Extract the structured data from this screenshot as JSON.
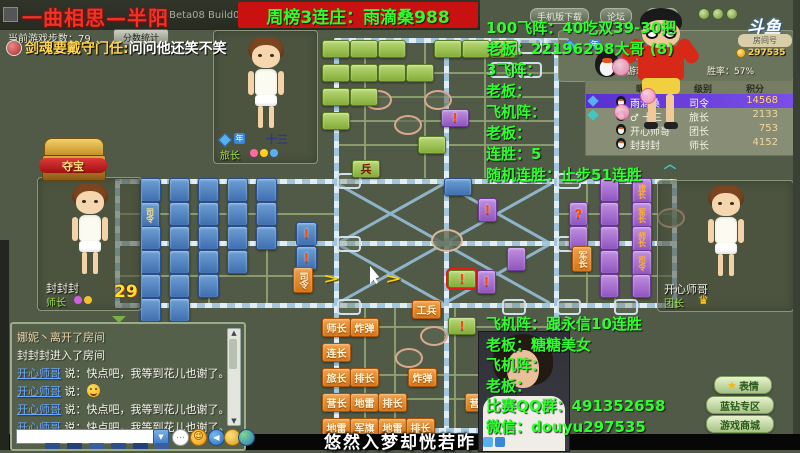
{
  "window": {
    "title": "一曲相思—半阳",
    "version": "2.1 Beta08 Build033",
    "banner": "周榜3连庄：雨滴桑988",
    "nav_buttons": [
      "手机版下载",
      "论坛",
      "设置"
    ],
    "logo": "斗鱼",
    "room_label": "房间号",
    "room_coins": "297535",
    "steps": "当前游戏步数：79",
    "score_button": "分数统计"
  },
  "overlay": {
    "chat_name": "剑魂要戴守门任:",
    "chat_msg": "问问他还笑不笑",
    "text_color": "#2dff2d",
    "right_top": [
      "100飞阵：40吃双39-30把",
      "老板：22196298大哥 (8)",
      "3飞阵：",
      "老板：",
      "飞机阵：",
      "老板：",
      "连胜：5",
      "随机连胜：止步51连胜"
    ],
    "right_bottom": [
      "飞机阵：跟永信10连胜",
      "老板：糖糖美女",
      "飞机阵：",
      "老板：",
      "比赛QQ群：491352658",
      "微信：douyu297535"
    ],
    "subtitle": "悠然入梦却恍若昨"
  },
  "players": {
    "top": {
      "name": "十三",
      "level": "旅长"
    },
    "left": {
      "name": "封封封",
      "level": "师长",
      "timer": "29"
    },
    "right": {
      "name": "开心师哥",
      "level": "团长"
    },
    "self_info": {
      "level": "级别：司令",
      "coins": "游戏币：0",
      "winrate": "胜率：57%"
    }
  },
  "ranking": {
    "headers": [
      "昵称",
      "级别",
      "积分"
    ],
    "rows": [
      {
        "icon": "#58b0f0",
        "name": "雨滴桑",
        "level": "司令",
        "score": "14568",
        "highlight": true
      },
      {
        "icon": "#40c8c0",
        "name": "♂ 十三",
        "level": "旅长",
        "score": "2133",
        "highlight": false
      },
      {
        "icon": "",
        "name": "开心师哥",
        "level": "团长",
        "score": "753",
        "highlight": false
      },
      {
        "icon": "",
        "name": "封封封",
        "level": "师长",
        "score": "4152",
        "highlight": false
      }
    ]
  },
  "treasure": {
    "label": "夺宝"
  },
  "side_buttons": [
    {
      "label": "表情",
      "star": true
    },
    {
      "label": "蓝钻专区",
      "star": false
    },
    {
      "label": "游戏商城",
      "star": false
    }
  ],
  "chat": {
    "messages": [
      {
        "kind": "sys",
        "text": "娜妮丶离开了房间"
      },
      {
        "kind": "ent",
        "text": "封封封进入了房间"
      },
      {
        "kind": "user",
        "name": "开心师哥",
        "prefix": "说：",
        "text": "快点吧，我等到花儿也谢了。",
        "emoji": false
      },
      {
        "kind": "user",
        "name": "开心师哥",
        "prefix": "说：",
        "text": "",
        "emoji": true
      },
      {
        "kind": "user",
        "name": "开心师哥",
        "prefix": "说：",
        "text": "快点吧，我等到花儿也谢了。",
        "emoji": false
      },
      {
        "kind": "user",
        "name": "开心师哥",
        "prefix": "说：",
        "text": "快点吧，我等到花儿也谢了。",
        "emoji": false
      }
    ]
  },
  "board": {
    "pieces": [
      {
        "x": 140,
        "y": 178,
        "c": "blue"
      },
      {
        "x": 169,
        "y": 178,
        "c": "blue"
      },
      {
        "x": 198,
        "y": 178,
        "c": "blue"
      },
      {
        "x": 227,
        "y": 178,
        "c": "blue"
      },
      {
        "x": 256,
        "y": 178,
        "c": "blue"
      },
      {
        "x": 140,
        "y": 202,
        "c": "blue",
        "l": "司令",
        "v": true
      },
      {
        "x": 169,
        "y": 202,
        "c": "blue"
      },
      {
        "x": 198,
        "y": 202,
        "c": "blue"
      },
      {
        "x": 227,
        "y": 202,
        "c": "blue"
      },
      {
        "x": 256,
        "y": 202,
        "c": "blue"
      },
      {
        "x": 140,
        "y": 226,
        "c": "blue"
      },
      {
        "x": 169,
        "y": 226,
        "c": "blue"
      },
      {
        "x": 198,
        "y": 226,
        "c": "blue"
      },
      {
        "x": 227,
        "y": 226,
        "c": "blue"
      },
      {
        "x": 256,
        "y": 226,
        "c": "blue"
      },
      {
        "x": 140,
        "y": 250,
        "c": "blue"
      },
      {
        "x": 169,
        "y": 250,
        "c": "blue"
      },
      {
        "x": 198,
        "y": 250,
        "c": "blue"
      },
      {
        "x": 227,
        "y": 250,
        "c": "blue"
      },
      {
        "x": 140,
        "y": 274,
        "c": "blue"
      },
      {
        "x": 169,
        "y": 274,
        "c": "blue"
      },
      {
        "x": 198,
        "y": 274,
        "c": "blue"
      },
      {
        "x": 140,
        "y": 298,
        "c": "blue"
      },
      {
        "x": 169,
        "y": 298,
        "c": "blue"
      },
      {
        "x": 296,
        "y": 222,
        "c": "blue",
        "l": "!"
      },
      {
        "x": 296,
        "y": 246,
        "c": "blue",
        "l": "!"
      },
      {
        "x": 444,
        "y": 178,
        "c": "blue",
        "land": true
      },
      {
        "x": 322,
        "y": 40,
        "c": "green"
      },
      {
        "x": 350,
        "y": 40,
        "c": "green"
      },
      {
        "x": 378,
        "y": 40,
        "c": "green"
      },
      {
        "x": 434,
        "y": 40,
        "c": "green"
      },
      {
        "x": 462,
        "y": 40,
        "c": "green"
      },
      {
        "x": 490,
        "y": 40,
        "c": "green"
      },
      {
        "x": 322,
        "y": 64,
        "c": "green"
      },
      {
        "x": 350,
        "y": 64,
        "c": "green"
      },
      {
        "x": 378,
        "y": 64,
        "c": "green"
      },
      {
        "x": 406,
        "y": 64,
        "c": "green"
      },
      {
        "x": 322,
        "y": 88,
        "c": "green"
      },
      {
        "x": 350,
        "y": 88,
        "c": "green"
      },
      {
        "x": 322,
        "y": 112,
        "c": "green"
      },
      {
        "x": 418,
        "y": 136,
        "c": "green"
      },
      {
        "x": 352,
        "y": 160,
        "c": "green",
        "l": "兵"
      },
      {
        "x": 448,
        "y": 270,
        "c": "green",
        "l": "!",
        "sel": true
      },
      {
        "x": 448,
        "y": 317,
        "c": "green",
        "l": "!"
      },
      {
        "x": 569,
        "y": 202,
        "c": "purple",
        "l": "?"
      },
      {
        "x": 569,
        "y": 226,
        "c": "purple"
      },
      {
        "x": 600,
        "y": 178,
        "c": "purple"
      },
      {
        "x": 600,
        "y": 202,
        "c": "purple"
      },
      {
        "x": 600,
        "y": 226,
        "c": "purple"
      },
      {
        "x": 600,
        "y": 250,
        "c": "purple"
      },
      {
        "x": 600,
        "y": 274,
        "c": "purple"
      },
      {
        "x": 632,
        "y": 178,
        "c": "purple",
        "l": "旅长",
        "v": true
      },
      {
        "x": 632,
        "y": 202,
        "c": "purple",
        "l": "军长",
        "v": true
      },
      {
        "x": 632,
        "y": 226,
        "c": "purple",
        "l": "师长",
        "v": true
      },
      {
        "x": 632,
        "y": 250,
        "c": "purple",
        "l": "司令",
        "v": true
      },
      {
        "x": 632,
        "y": 274,
        "c": "purple"
      },
      {
        "x": 507,
        "y": 247,
        "c": "purple"
      },
      {
        "x": 478,
        "y": 198,
        "c": "purple",
        "l": "!"
      },
      {
        "x": 477,
        "y": 270,
        "c": "purple",
        "l": "!"
      },
      {
        "x": 441,
        "y": 109,
        "c": "purple",
        "l": "!",
        "land": true
      },
      {
        "x": 412,
        "y": 300,
        "c": "orange",
        "l": "工兵"
      },
      {
        "x": 322,
        "y": 318,
        "c": "orange",
        "l": "师长"
      },
      {
        "x": 350,
        "y": 318,
        "c": "orange",
        "l": "炸弹"
      },
      {
        "x": 322,
        "y": 343,
        "c": "orange",
        "l": "连长"
      },
      {
        "x": 322,
        "y": 368,
        "c": "orange",
        "l": "旅长"
      },
      {
        "x": 350,
        "y": 368,
        "c": "orange",
        "l": "排长"
      },
      {
        "x": 408,
        "y": 368,
        "c": "orange",
        "l": "炸弹"
      },
      {
        "x": 322,
        "y": 393,
        "c": "orange",
        "l": "营长"
      },
      {
        "x": 350,
        "y": 393,
        "c": "orange",
        "l": "地雷"
      },
      {
        "x": 378,
        "y": 393,
        "c": "orange",
        "l": "排长"
      },
      {
        "x": 465,
        "y": 393,
        "c": "orange",
        "l": "营长"
      },
      {
        "x": 322,
        "y": 418,
        "c": "orange",
        "l": "地雷"
      },
      {
        "x": 350,
        "y": 418,
        "c": "orange",
        "l": "军旗"
      },
      {
        "x": 378,
        "y": 418,
        "c": "orange",
        "l": "地雷"
      },
      {
        "x": 406,
        "y": 418,
        "c": "orange",
        "l": "排长"
      },
      {
        "x": 293,
        "y": 267,
        "c": "orange",
        "l": "司令",
        "v": true
      },
      {
        "x": 572,
        "y": 246,
        "c": "orange",
        "l": "军长",
        "v": true
      }
    ],
    "slots": [
      [
        337,
        173
      ],
      [
        557,
        173
      ],
      [
        337,
        236
      ],
      [
        557,
        236
      ],
      [
        337,
        299
      ],
      [
        502,
        299
      ],
      [
        557,
        299
      ],
      [
        614,
        299
      ],
      [
        518,
        38
      ],
      [
        546,
        38
      ],
      [
        490,
        62
      ],
      [
        518,
        62
      ]
    ],
    "camps": [
      [
        364,
        90
      ],
      [
        424,
        90
      ],
      [
        394,
        115
      ],
      [
        395,
        348
      ],
      [
        420,
        326
      ],
      [
        657,
        208
      ]
    ],
    "arrows": [
      [
        326,
        272
      ],
      [
        388,
        272
      ]
    ]
  }
}
